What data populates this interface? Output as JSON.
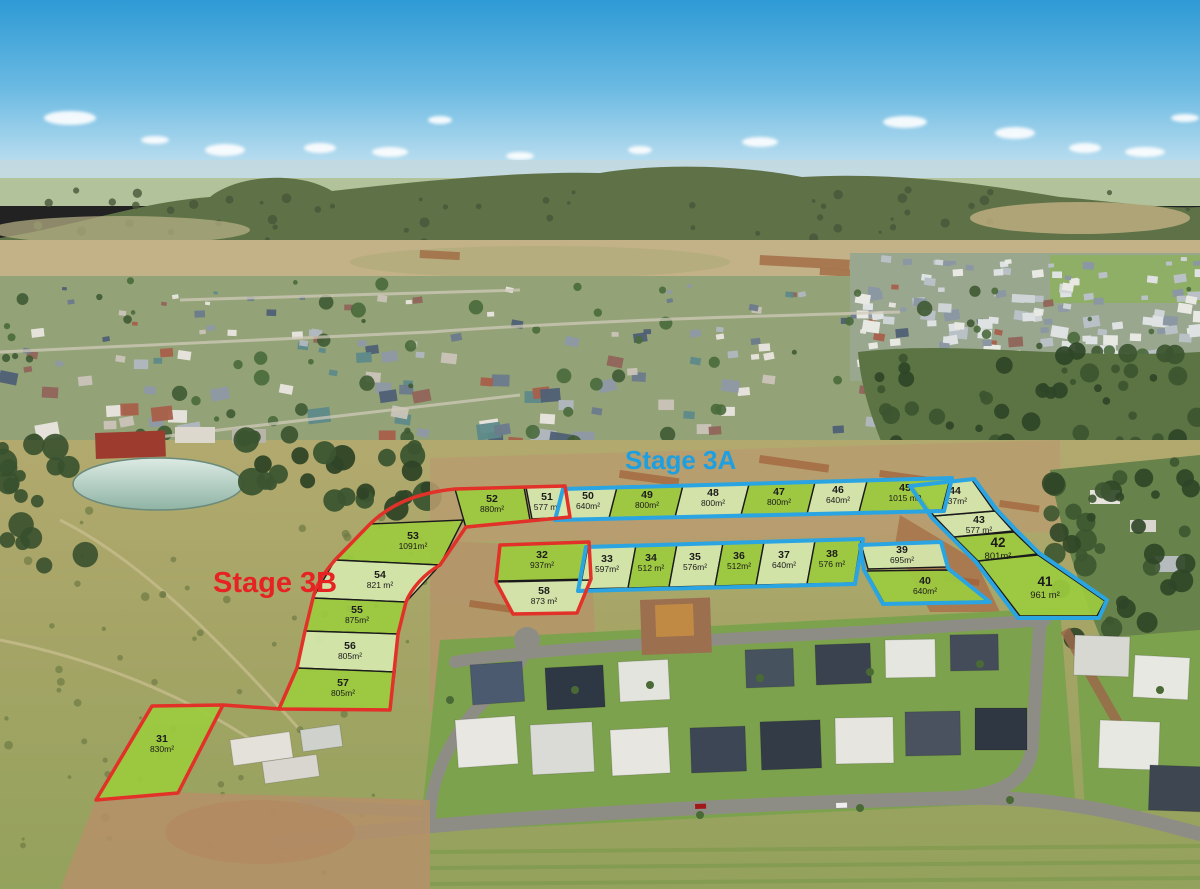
{
  "stages": {
    "a": {
      "label": "Stage 3A",
      "color": "#1E9FE0"
    },
    "b": {
      "label": "Stage 3B",
      "color": "#E62222"
    }
  },
  "lots": {
    "31": {
      "number": "31",
      "area": "830m²",
      "stage": "3B"
    },
    "32": {
      "number": "32",
      "area": "937m²",
      "stage": "3B"
    },
    "33": {
      "number": "33",
      "area": "597m²",
      "stage": "3A"
    },
    "34": {
      "number": "34",
      "area": "512 m²",
      "stage": "3A"
    },
    "35": {
      "number": "35",
      "area": "576m²",
      "stage": "3A"
    },
    "36": {
      "number": "36",
      "area": "512m²",
      "stage": "3A"
    },
    "37": {
      "number": "37",
      "area": "640m²",
      "stage": "3A"
    },
    "38": {
      "number": "38",
      "area": "576 m²",
      "stage": "3A"
    },
    "39": {
      "number": "39",
      "area": "695m²",
      "stage": "3A"
    },
    "40": {
      "number": "40",
      "area": "640m²",
      "stage": "3A"
    },
    "41": {
      "number": "41",
      "area": "961 m²",
      "stage": "3A"
    },
    "42": {
      "number": "42",
      "area": "801m²",
      "stage": "3A"
    },
    "43": {
      "number": "43",
      "area": "577 m²",
      "stage": "3A"
    },
    "44": {
      "number": "44",
      "area": "737m²",
      "stage": "3A"
    },
    "45": {
      "number": "45",
      "area": "1015 m2",
      "stage": "3A"
    },
    "46": {
      "number": "46",
      "area": "640m²",
      "stage": "3A"
    },
    "47": {
      "number": "47",
      "area": "800m²",
      "stage": "3A"
    },
    "48": {
      "number": "48",
      "area": "800m²",
      "stage": "3A"
    },
    "49": {
      "number": "49",
      "area": "800m²",
      "stage": "3A"
    },
    "50": {
      "number": "50",
      "area": "640m²",
      "stage": "3A"
    },
    "51": {
      "number": "51",
      "area": "577 m²",
      "stage": "3B"
    },
    "52": {
      "number": "52",
      "area": "880m²",
      "stage": "3B"
    },
    "53": {
      "number": "53",
      "area": "1091m²",
      "stage": "3B"
    },
    "54": {
      "number": "54",
      "area": "821 m²",
      "stage": "3B"
    },
    "55": {
      "number": "55",
      "area": "875m²",
      "stage": "3B"
    },
    "56": {
      "number": "56",
      "area": "805m²",
      "stage": "3B"
    },
    "57": {
      "number": "57",
      "area": "805m²",
      "stage": "3B"
    },
    "58": {
      "number": "58",
      "area": "873 m²",
      "stage": "3B"
    }
  },
  "palette": {
    "lot_fill_bright": "#9CCB3E",
    "lot_fill_pale": "#D6E8AE",
    "stage_a_border": "#2AA5E2",
    "stage_b_border": "#E23128",
    "lot_divider": "#1A1A1A"
  }
}
